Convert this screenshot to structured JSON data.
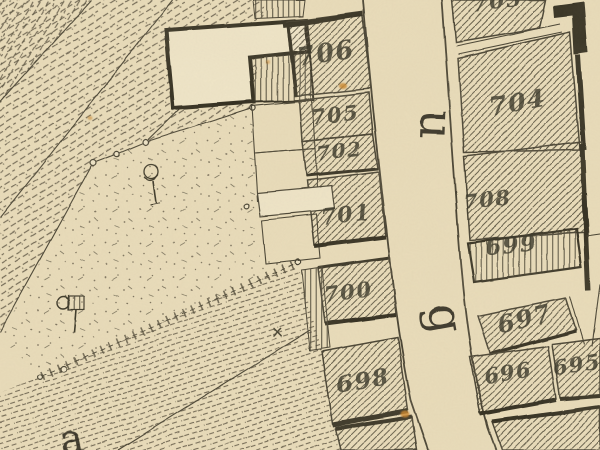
{
  "map": {
    "kind": "historic-cadastral-map",
    "colors": {
      "paper": "#e9dcba",
      "paper_light": "#efe5c8",
      "ink": "#433e2e",
      "ink_dark": "#2f2b1e",
      "stain": "#c9872f"
    },
    "parcel_labels": [
      {
        "text": "706",
        "x": 327,
        "y": 62,
        "rot": -9,
        "size": 26
      },
      {
        "text": "705",
        "x": 336,
        "y": 122,
        "rot": -7,
        "size": 21
      },
      {
        "text": "702",
        "x": 340,
        "y": 158,
        "rot": -6,
        "size": 20
      },
      {
        "text": "701",
        "x": 347,
        "y": 222,
        "rot": -7,
        "size": 22
      },
      {
        "text": "700",
        "x": 349,
        "y": 299,
        "rot": -7,
        "size": 21
      },
      {
        "text": "698",
        "x": 364,
        "y": 388,
        "rot": -9,
        "size": 23
      },
      {
        "text": "703",
        "x": 498,
        "y": 9,
        "rot": -8,
        "size": 22
      },
      {
        "text": "704",
        "x": 519,
        "y": 111,
        "rot": -10,
        "size": 25
      },
      {
        "text": "708",
        "x": 488,
        "y": 207,
        "rot": -6,
        "size": 21
      },
      {
        "text": "699",
        "x": 512,
        "y": 253,
        "rot": -5,
        "size": 23
      },
      {
        "text": "697",
        "x": 527,
        "y": 327,
        "rot": -14,
        "size": 24
      },
      {
        "text": "696",
        "x": 509,
        "y": 380,
        "rot": -9,
        "size": 21
      },
      {
        "text": "695",
        "x": 578,
        "y": 372,
        "rot": -9,
        "size": 21
      }
    ],
    "street_letters": [
      {
        "text": "u",
        "x": 421,
        "y": 124,
        "rot": 92,
        "size": 46
      },
      {
        "text": "g",
        "x": 430,
        "y": 321,
        "rot": 80,
        "size": 46
      },
      {
        "text": "a",
        "x": 74,
        "y": 453,
        "rot": -12,
        "size": 40
      }
    ],
    "symbols": [
      {
        "name": "tree-symbol",
        "glyph": "sketched tree"
      },
      {
        "name": "flag-symbol",
        "glyph": "hatched flag on pole"
      },
      {
        "name": "x-mark",
        "glyph": "×"
      },
      {
        "name": "boundary-marker",
        "glyph": "○"
      },
      {
        "name": "fence-line",
        "glyph": "dashed line with ticks"
      }
    ]
  }
}
